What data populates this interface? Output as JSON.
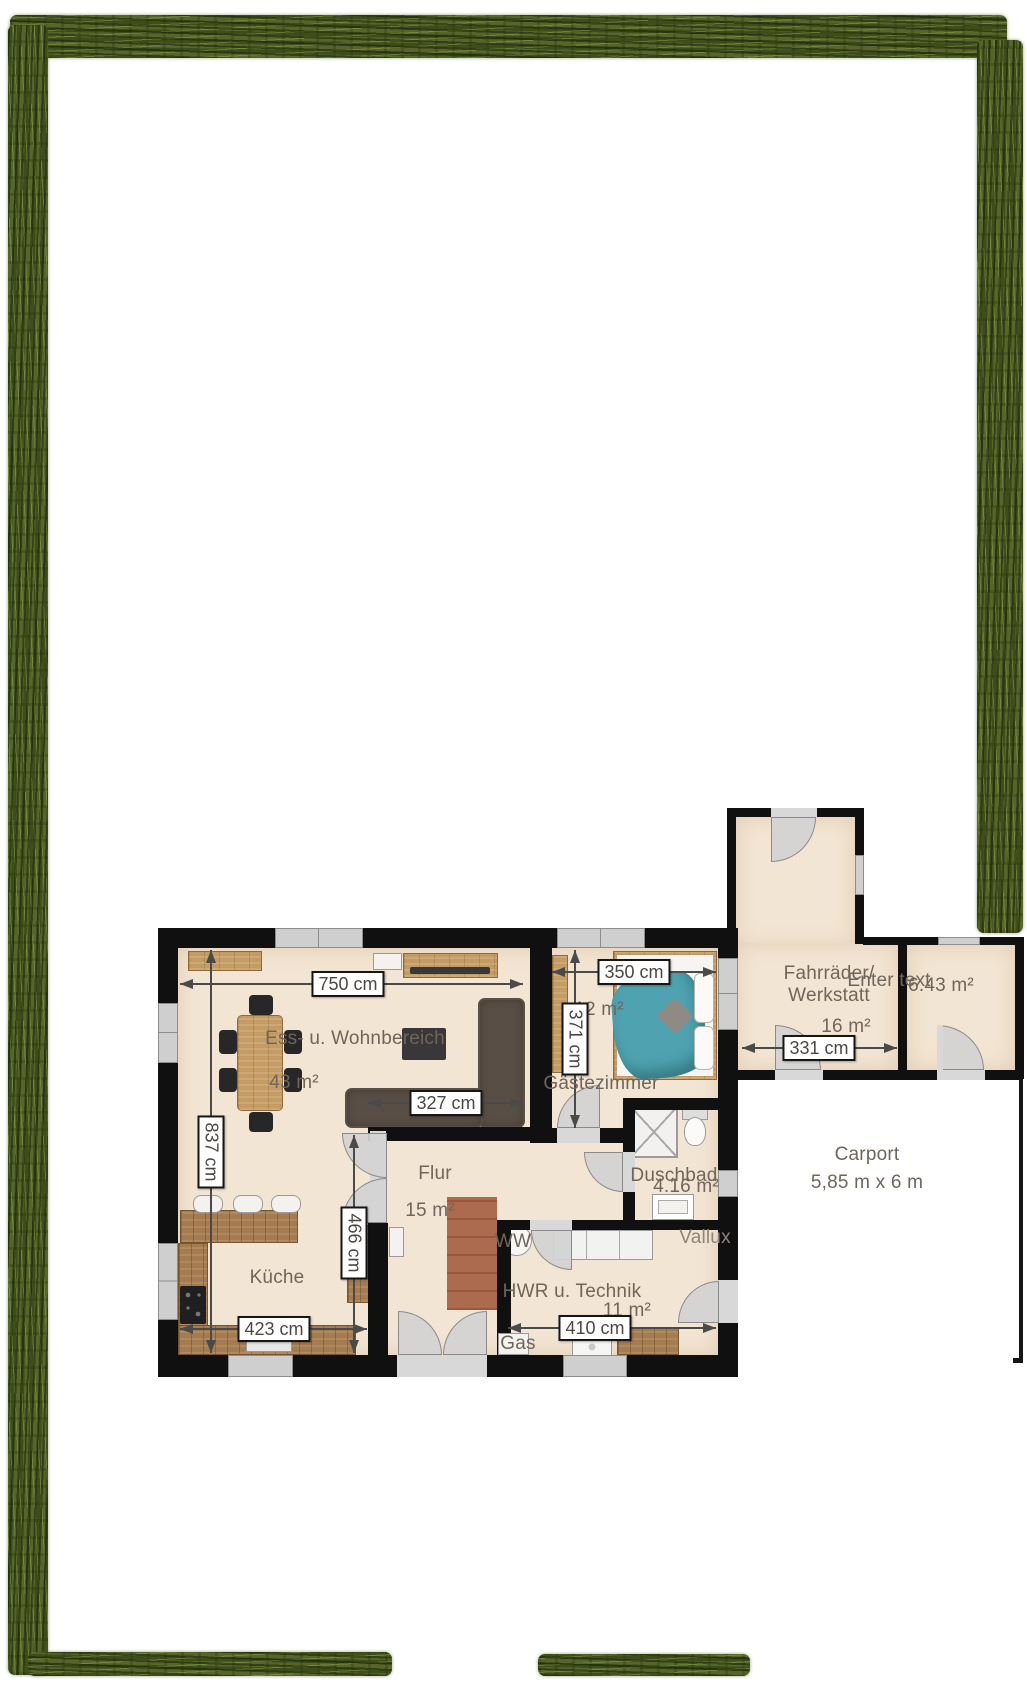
{
  "floorplan": {
    "rooms": {
      "wohnbereich": {
        "label": "Ess- u. Wohnbereich",
        "area": "43 m²"
      },
      "kueche": {
        "label": "Küche"
      },
      "flur": {
        "label": "Flur",
        "area": "15 m²"
      },
      "gaestezimmer": {
        "label": "Gästezimmer",
        "area": "12 m²"
      },
      "duschbad": {
        "label": "Duschbad",
        "area": "4.16 m²"
      },
      "hwr": {
        "label": "HWR u. Technik",
        "area": "11 m²"
      },
      "werkstatt": {
        "label1": "Fahrräder/",
        "label2": "Werkstatt",
        "area": "16 m²"
      },
      "nebenraum": {
        "label": "Enter text",
        "area": "6.43 m²"
      },
      "carport": {
        "label": "Carport",
        "size": "5,85 m x 6 m"
      }
    },
    "annotations": {
      "ww": "WW",
      "gas": "Gas",
      "vallux": "Vallux"
    },
    "dimensions": {
      "d750": "750 cm",
      "d837": "837 cm",
      "d327": "327 cm",
      "d466": "466 cm",
      "d350": "350 cm",
      "d371": "371 cm",
      "d423": "423 cm",
      "d410": "410 cm",
      "d331": "331 cm"
    },
    "colors": {
      "hedge": "#57652a",
      "wall": "#101010",
      "floor": "#f3e5d3",
      "window_door": "#cfcfcf",
      "wood_light": "#c49b62",
      "wood_dark": "#a57c50",
      "sofa": "#594e45",
      "bed_cover": "#4fa3b1",
      "rug": "#ad6b4e",
      "dimension_text": "#4d4843",
      "label_text": "#6f655a"
    }
  }
}
